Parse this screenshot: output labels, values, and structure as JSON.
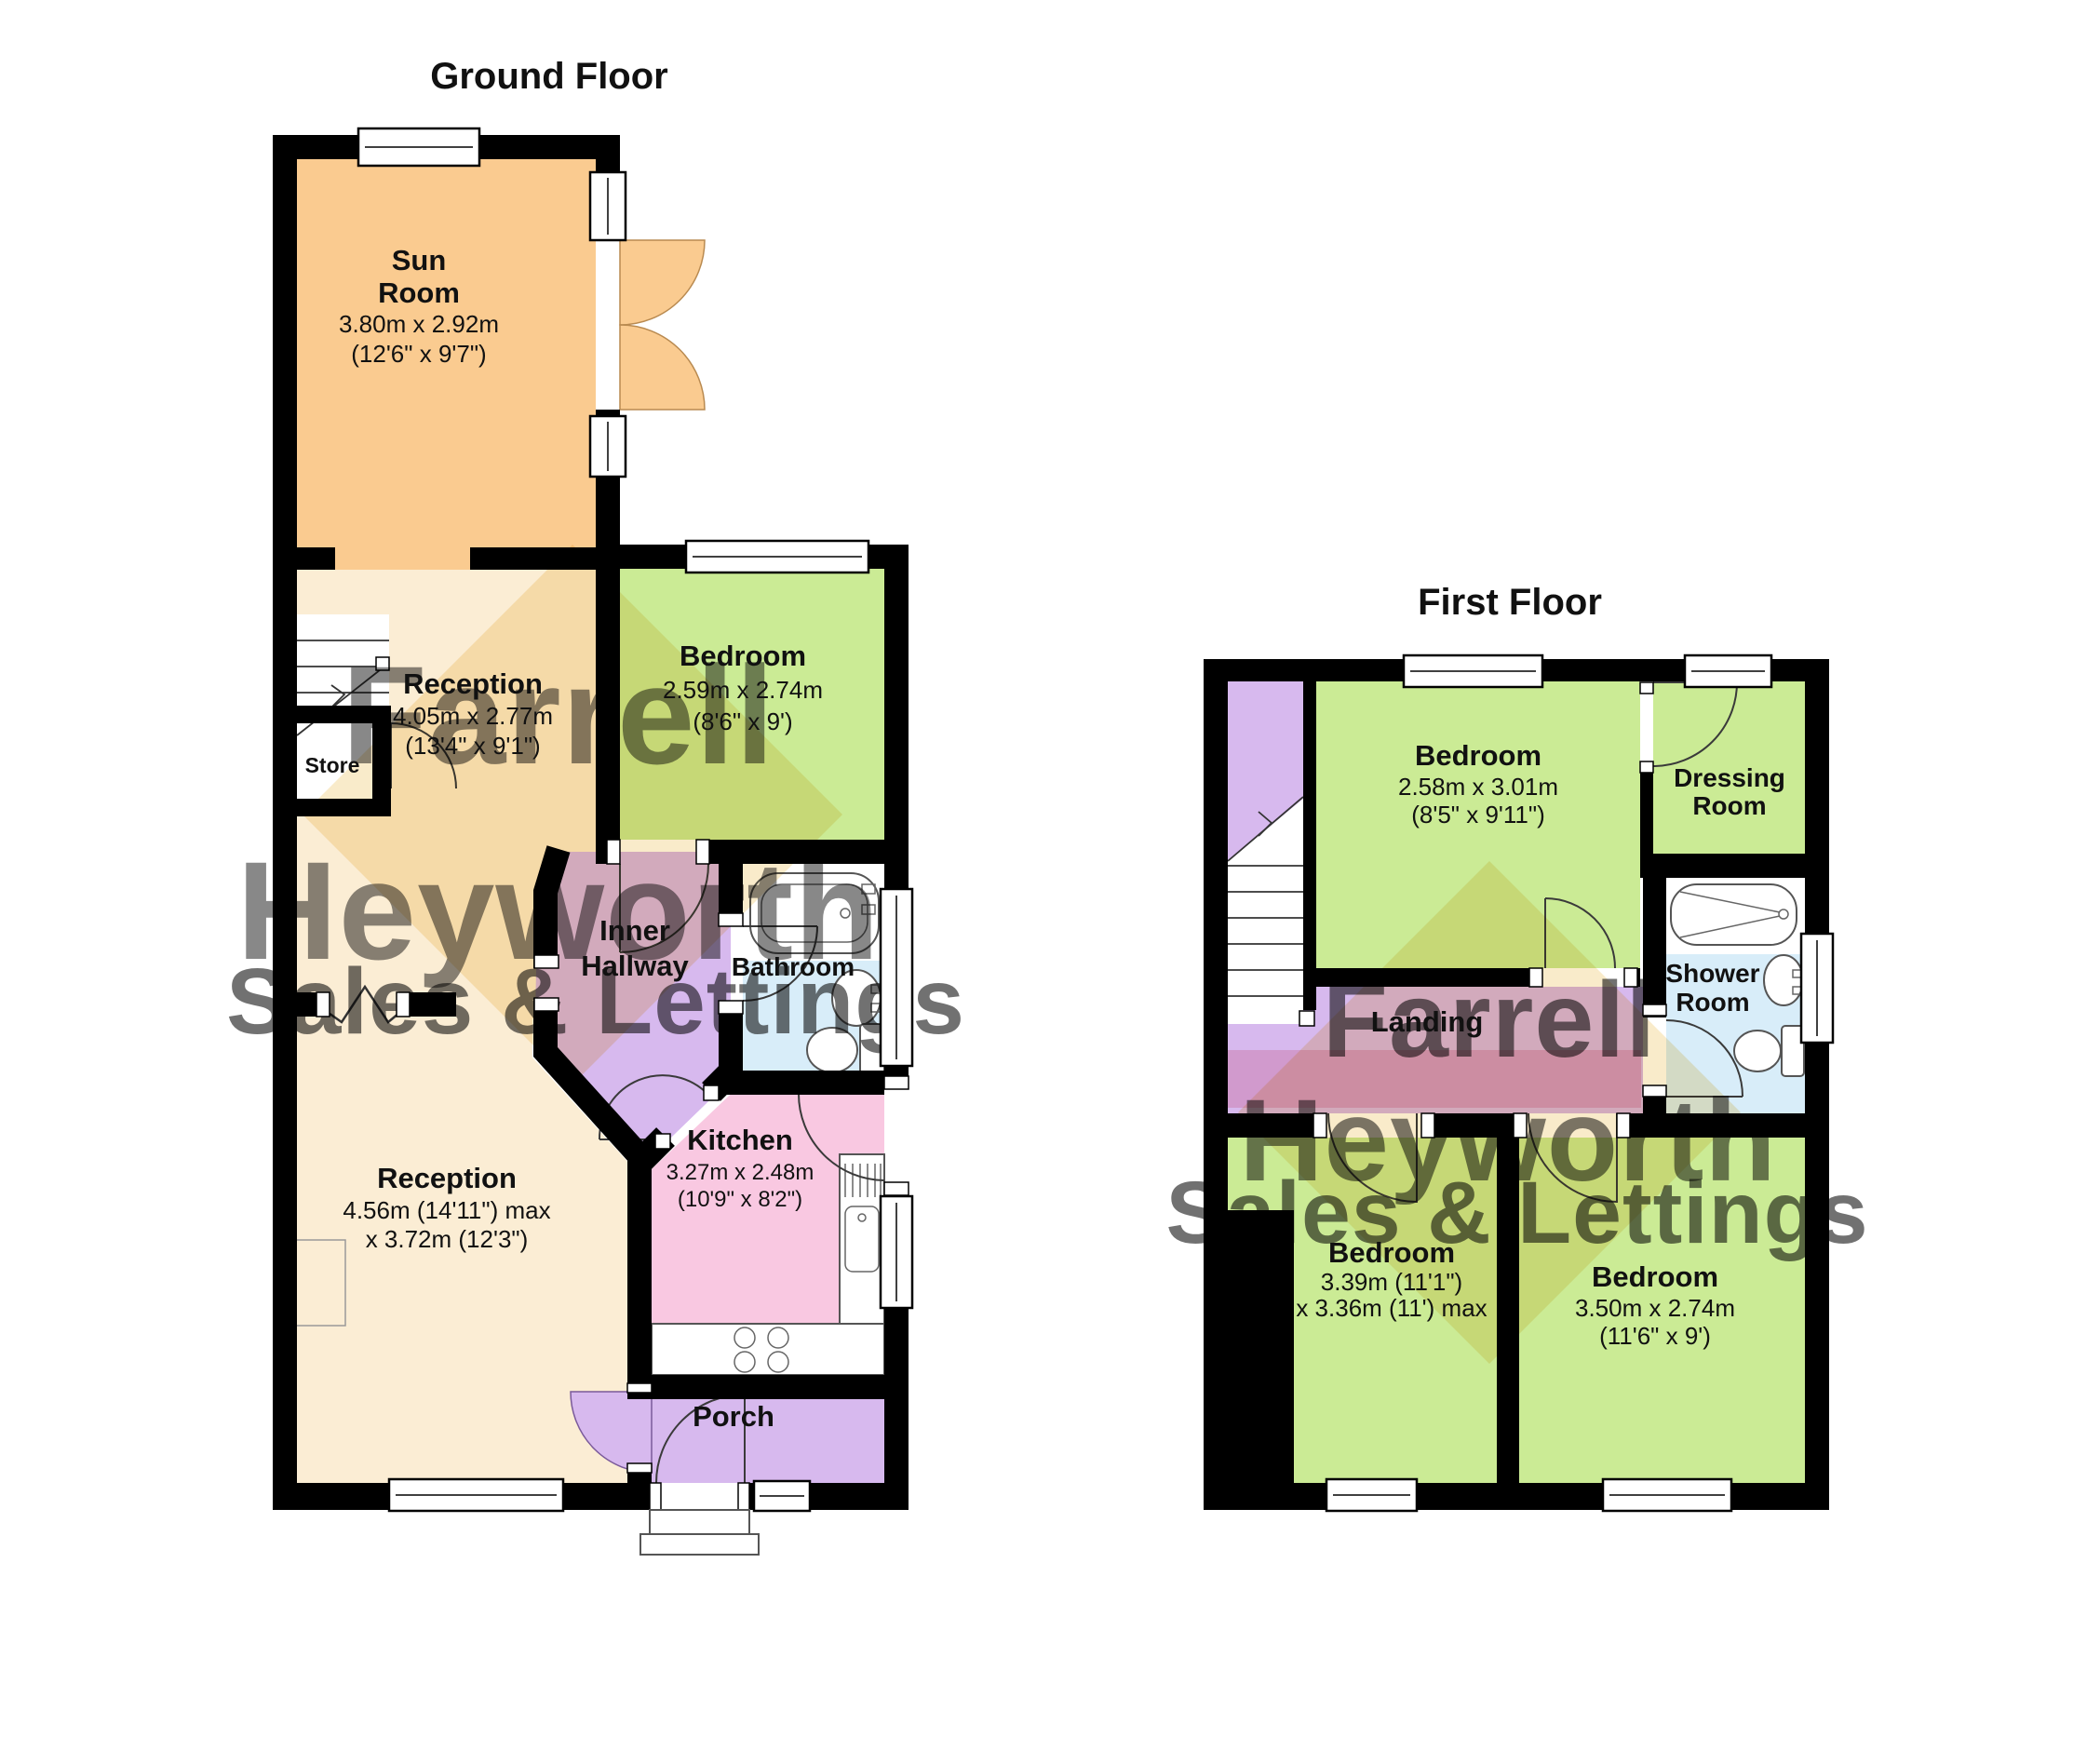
{
  "ground_floor": {
    "title": "Ground Floor",
    "rooms": {
      "sun_room": {
        "name_line1": "Sun",
        "name_line2": "Room",
        "dims_metric": "3.80m x 2.92m",
        "dims_imperial": "(12'6\" x 9'7\")"
      },
      "reception_top": {
        "name": "Reception",
        "dims_metric": "4.05m x 2.77m",
        "dims_imperial": "(13'4\" x 9'1\")"
      },
      "store": {
        "name": "Store"
      },
      "bedroom": {
        "name": "Bedroom",
        "dims_metric": "2.59m x 2.74m",
        "dims_imperial": "(8'6\" x 9')"
      },
      "bathroom": {
        "name": "Bathroom"
      },
      "inner_hallway": {
        "name_line1": "Inner",
        "name_line2": "Hallway"
      },
      "kitchen": {
        "name": "Kitchen",
        "dims_metric": "3.27m x 2.48m",
        "dims_imperial": "(10'9\" x 8'2\")"
      },
      "reception_main": {
        "name": "Reception",
        "dims_line1": "4.56m (14'11\") max",
        "dims_line2": "x 3.72m (12'3\")"
      },
      "porch": {
        "name": "Porch"
      }
    }
  },
  "first_floor": {
    "title": "First Floor",
    "rooms": {
      "bedroom_front": {
        "name": "Bedroom",
        "dims_metric": "2.58m x 3.01m",
        "dims_imperial": "(8'5\" x 9'11\")"
      },
      "dressing_room": {
        "name_line1": "Dressing",
        "name_line2": "Room"
      },
      "shower_room": {
        "name_line1": "Shower",
        "name_line2": "Room"
      },
      "landing": {
        "name": "Landing"
      },
      "bedroom_left": {
        "name": "Bedroom",
        "dims_line1": "3.39m (11'1\")",
        "dims_line2": "x 3.36m (11') max"
      },
      "bedroom_right": {
        "name": "Bedroom",
        "dims_metric": "3.50m x 2.74m",
        "dims_imperial": "(11'6\" x 9')"
      }
    }
  },
  "watermark": {
    "line1": "Farrell",
    "line2": "Heyworth",
    "line3": "Sales & Lettings"
  },
  "colors": {
    "wall": "#000000",
    "sun_room_orange": "#FACB90",
    "cream": "#FBEDD4",
    "green": "#CBEB95",
    "blue": "#D8EDF9",
    "pink": "#F9C8E1",
    "purple": "#D7B9EE",
    "store_white": "#FFFFFF",
    "watermark_gray": "#8F8F8F",
    "watermark_salmon": "#EB9A8C",
    "watermark_red": "#D06A78",
    "watermark_purple": "#9080C2",
    "watermark_yellow": "#F0D080",
    "watermark_rose": "#EFA0B0"
  }
}
